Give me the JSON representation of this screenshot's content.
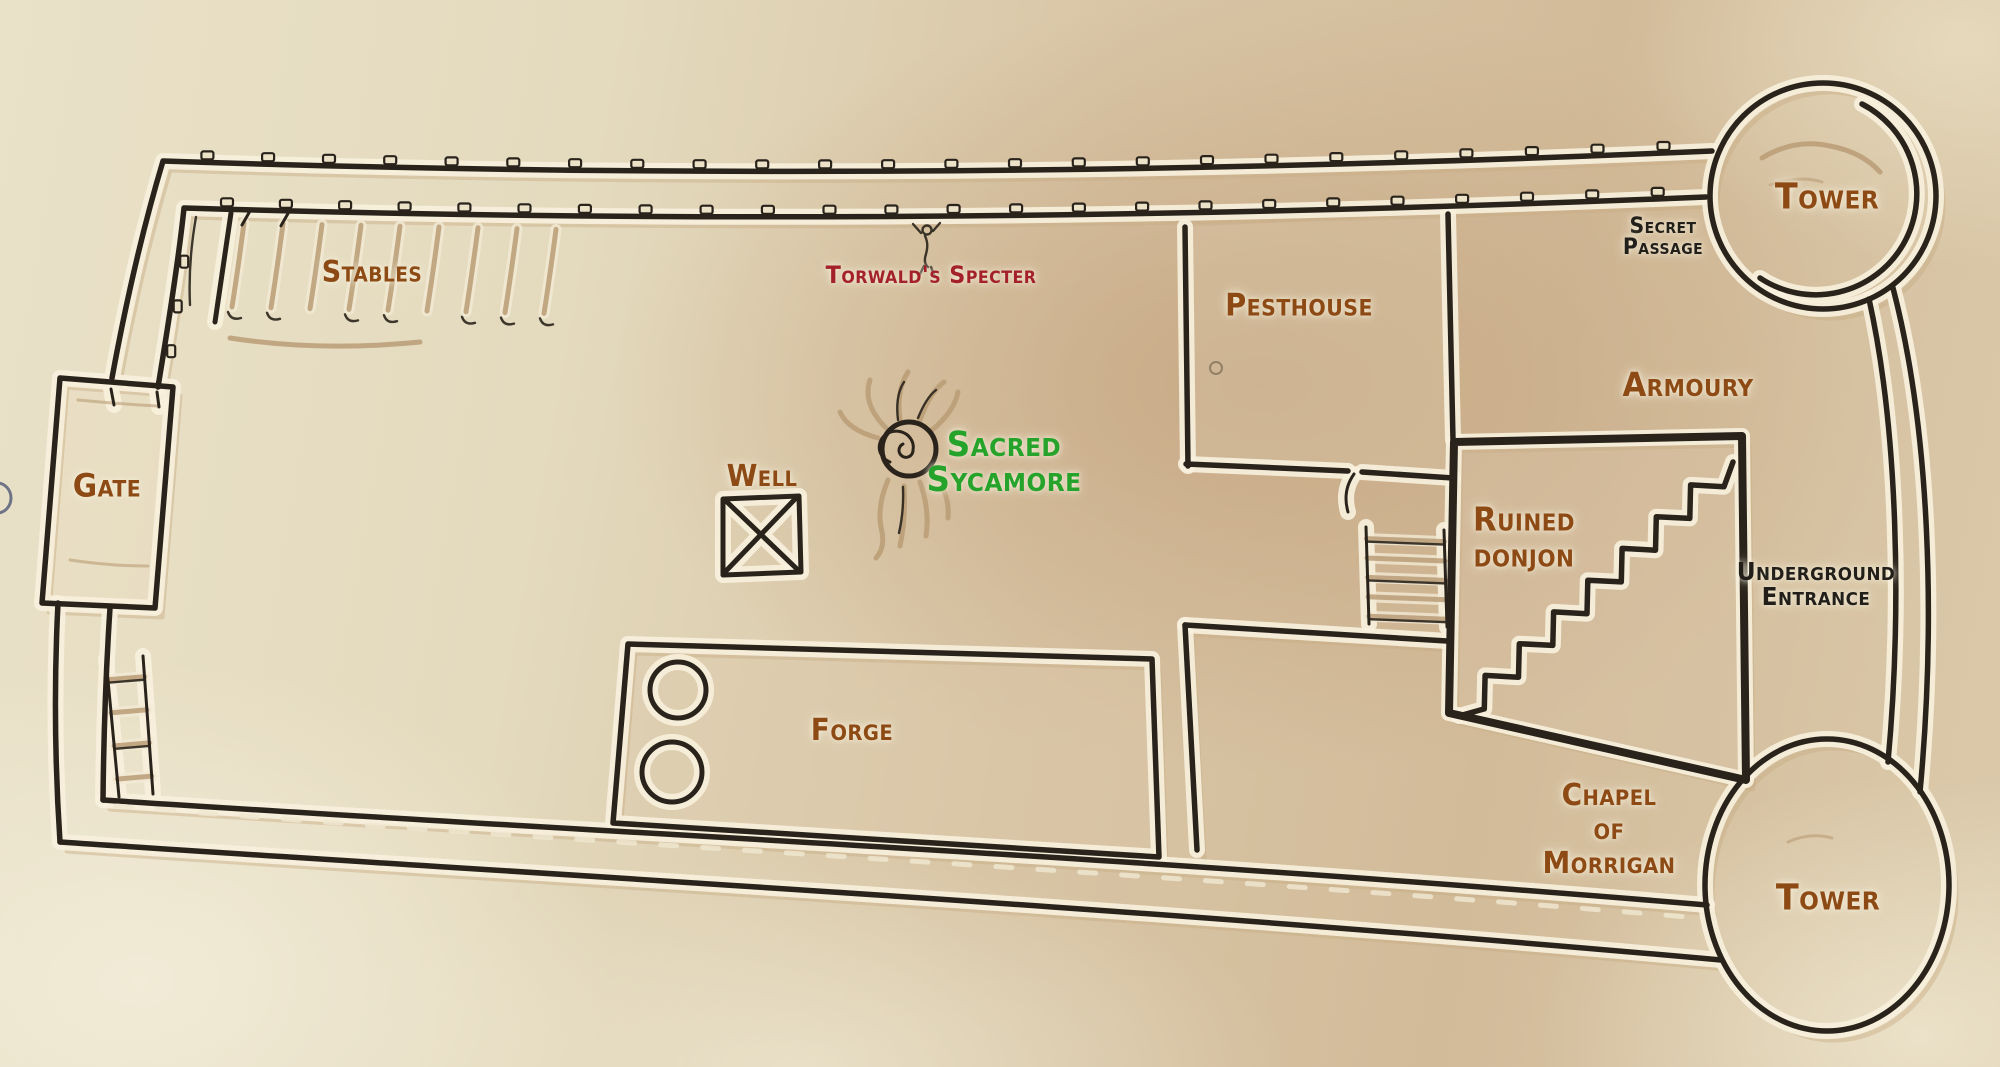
{
  "map": {
    "name": "castle-plan",
    "style": "hand-drawn parchment fortress map"
  },
  "labels": {
    "stables": {
      "text": "Stables"
    },
    "gate": {
      "text": "Gate"
    },
    "well": {
      "text": "Well"
    },
    "forge": {
      "text": "Forge"
    },
    "pesthouse": {
      "text": "Pesthouse"
    },
    "armoury": {
      "text": "Armoury"
    },
    "torwalds_specter": {
      "text": "Torwald's Specter"
    },
    "sacred_sycamore": {
      "text": "Sacred\nSycamore"
    },
    "secret_passage": {
      "text": "Secret\nPassage"
    },
    "underground_entrance": {
      "text": "Underground\nEntrance"
    },
    "ruined_donjon": {
      "text": "Ruined\ndonjon"
    },
    "chapel_of_morrigan": {
      "text": "Chapel\nof\nMorrigan"
    },
    "tower_northeast": {
      "text": "Tower"
    },
    "tower_southeast": {
      "text": "Tower"
    }
  },
  "colors": {
    "label_brown": "#8d4a14",
    "label_red": "#a42129",
    "label_green": "#26a32a",
    "label_black": "#221f1a",
    "wall_ink": "#29231b",
    "wall_halo": "#f7f0dc",
    "sketch_tan": "#b99c76",
    "sketch_echo": "#c8ac85",
    "parchment_light": "#e9e1c8",
    "parchment_warm": "#c8a682"
  }
}
